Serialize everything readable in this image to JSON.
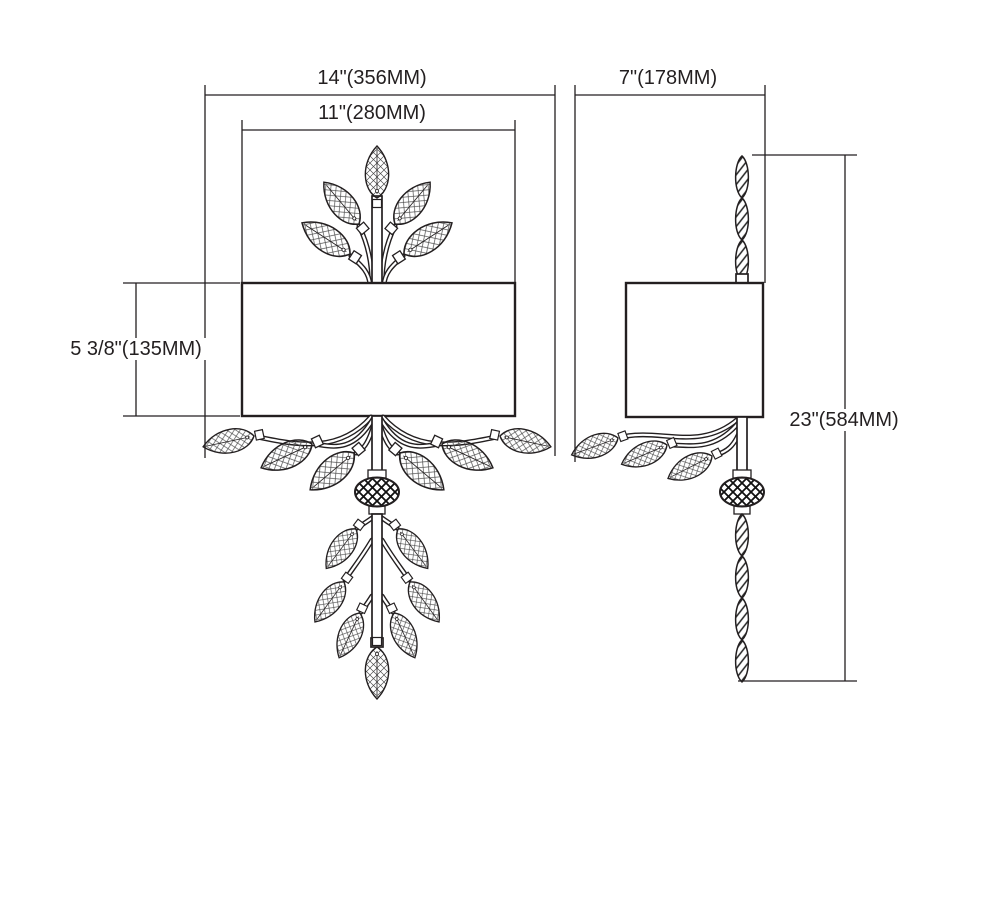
{
  "colors": {
    "background": "#ffffff",
    "line": "#231f20"
  },
  "diagram": {
    "subject": "Crystal leaf wall sconce dimension drawing",
    "views": [
      "front",
      "side"
    ],
    "dimensions": {
      "overall_width": "14\"(356MM)",
      "shade_width": "11\"(280MM)",
      "shade_height": "5 3/8\"(135MM)",
      "depth": "7\"(178MM)",
      "overall_height": "23\"(584MM)"
    }
  }
}
